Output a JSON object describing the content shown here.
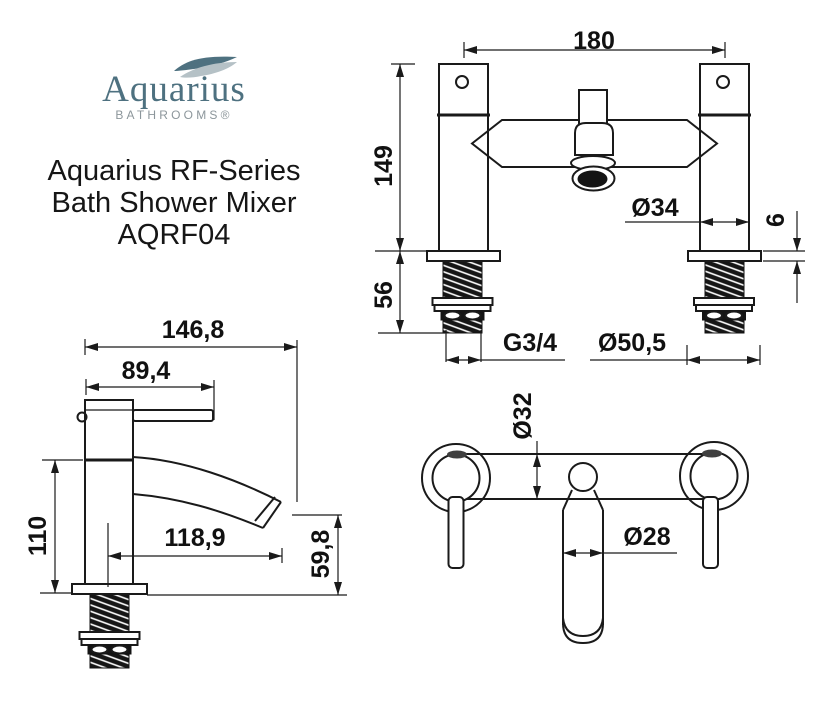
{
  "logo": {
    "brand": "Aquarius",
    "tagline": "BATHROOMS®",
    "brand_color": "#4e7180",
    "tagline_color": "#8c969b",
    "wave_dark": "#4e7180",
    "wave_light": "#b5c1c6"
  },
  "product": {
    "title_lines": [
      "Aquarius RF-Series",
      "Bath Shower Mixer",
      "AQRF04"
    ]
  },
  "drawings": {
    "front_view": {
      "name": "bath shower mixer front elevation",
      "dims": {
        "centres": "180",
        "height": "149",
        "tail": "56",
        "pillar": "Ø34",
        "deck": "6",
        "thread": "G3/4",
        "flange": "Ø50,5"
      }
    },
    "side_view": {
      "name": "mixer side profile",
      "dims": {
        "overall": "146,8",
        "handle": "89,4",
        "body": "110",
        "reach": "118,9",
        "drop": "59,8"
      }
    },
    "plan_view": {
      "name": "mixer plan view",
      "dims": {
        "body": "Ø32",
        "spout": "Ø28"
      }
    }
  },
  "line_color": "#1a1a1a"
}
